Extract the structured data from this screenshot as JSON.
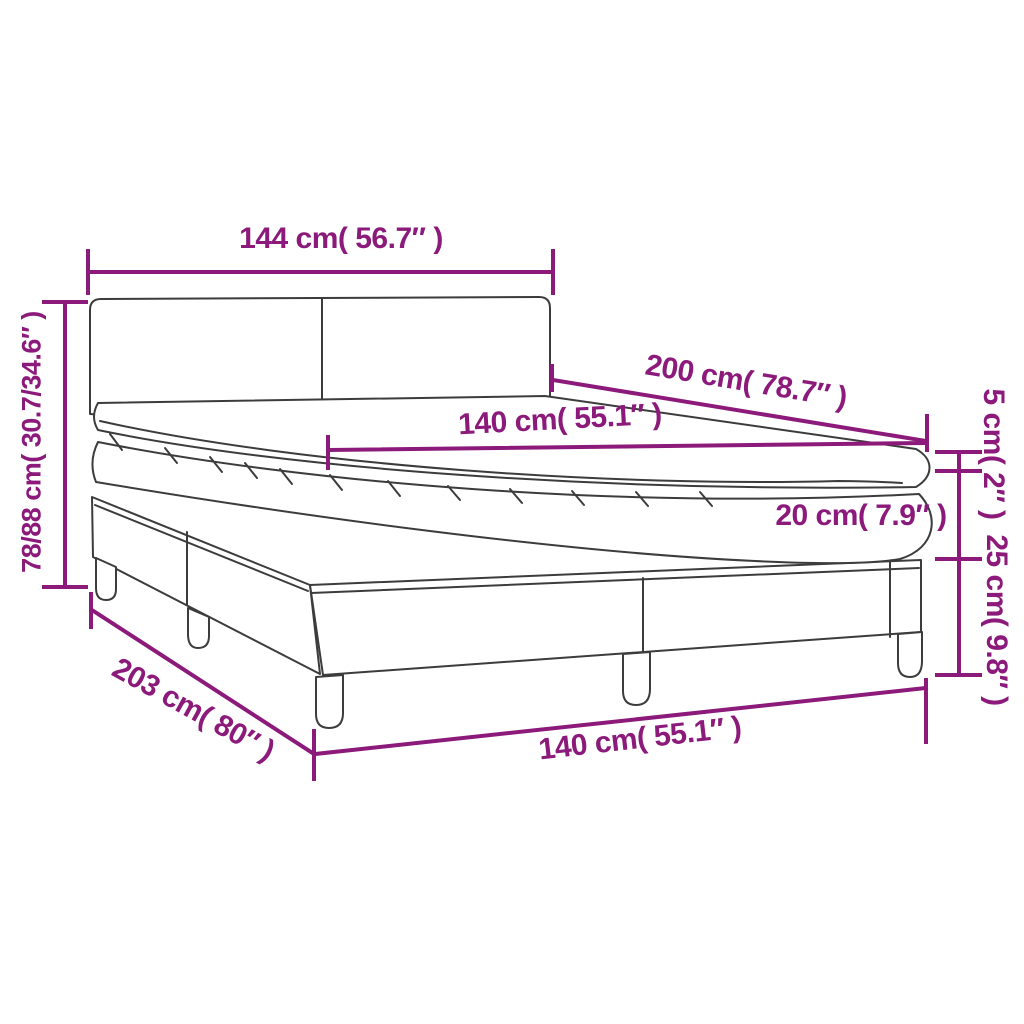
{
  "diagram_title": "Box spring bed dimension diagram",
  "colors": {
    "dimension_accent": "#8B1A7B",
    "outline": "#3C3C3C",
    "background": "#FFFFFF"
  },
  "annotations": [
    {
      "id": "headboard-width",
      "text": "144 cm( 56.7″ )"
    },
    {
      "id": "mattress-length",
      "text": "200 cm( 78.7″ )"
    },
    {
      "id": "mattress-width",
      "text": "140 cm( 55.1″ )"
    },
    {
      "id": "total-height",
      "text": "78/88 cm( 30.7/34.6″ )"
    },
    {
      "id": "topper-height",
      "text": "5 cm( 2″ )"
    },
    {
      "id": "mattress-height",
      "text": "20 cm( 7.9″ )"
    },
    {
      "id": "base-height",
      "text": "25 cm( 9.8″ )"
    },
    {
      "id": "total-length",
      "text": "203 cm( 80″ )"
    },
    {
      "id": "base-width",
      "text": "140 cm( 55.1″ )"
    }
  ]
}
